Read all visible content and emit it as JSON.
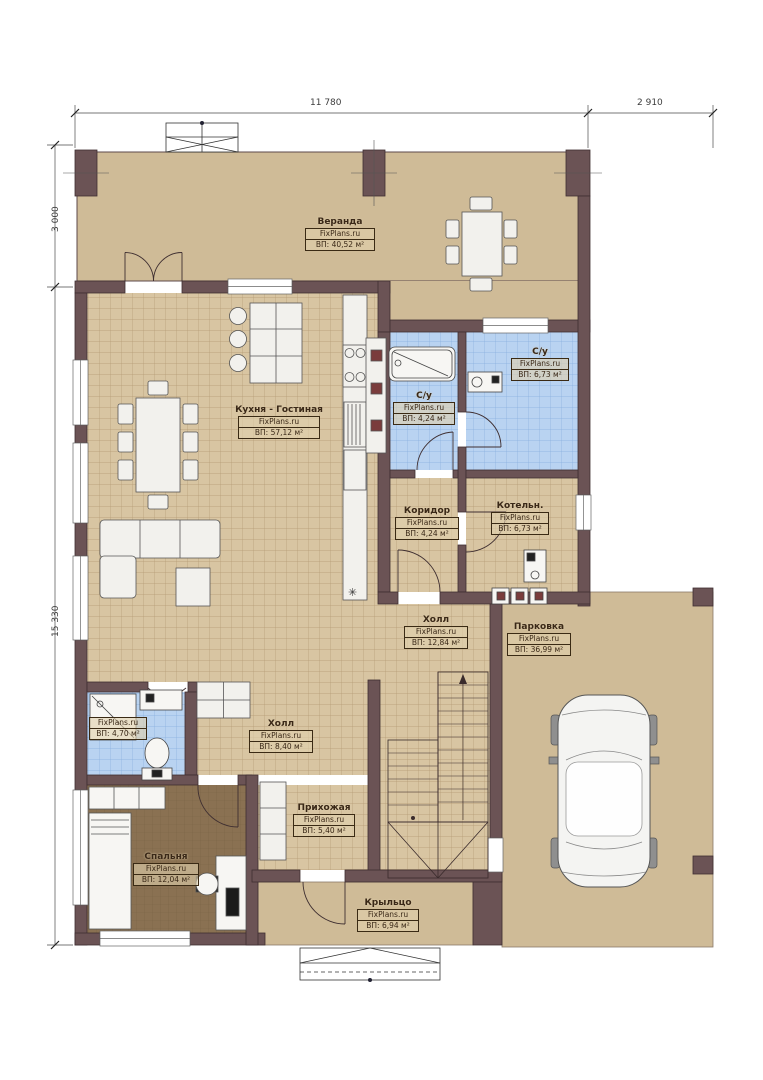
{
  "brand": "FixPlans.ru",
  "dimensions": {
    "top_main": "11 780",
    "top_right": "2 910",
    "left_top": "3 000",
    "left_main": "15 330"
  },
  "rooms": [
    {
      "title": "Веранда",
      "brand": "FixPlans.ru",
      "area": "ВП: 40,52 м²"
    },
    {
      "title": "Кухня - Гостиная",
      "brand": "FixPlans.ru",
      "area": "ВП: 57,12 м²"
    },
    {
      "title": "С/у",
      "brand": "FixPlans.ru",
      "area": "ВП: 4,24 м²"
    },
    {
      "title": "С/у",
      "brand": "FixPlans.ru",
      "area": "ВП: 6,73 м²"
    },
    {
      "title": "Коридор",
      "brand": "FixPlans.ru",
      "area": "ВП: 4,24 м²"
    },
    {
      "title": "Котельн.",
      "brand": "FixPlans.ru",
      "area": "ВП: 6,73 м²"
    },
    {
      "title": "Холл",
      "brand": "FixPlans.ru",
      "area": "ВП: 12,84 м²"
    },
    {
      "title": "Парковка",
      "brand": "FixPlans.ru",
      "area": "ВП: 36,99 м²"
    },
    {
      "title": "",
      "brand": "FixPlans.ru",
      "area": "ВП: 4,70 м²"
    },
    {
      "title": "Холл",
      "brand": "FixPlans.ru",
      "area": "ВП: 8,40 м²"
    },
    {
      "title": "Прихожая",
      "brand": "FixPlans.ru",
      "area": "ВП: 5,40 м²"
    },
    {
      "title": "Спальня",
      "brand": "FixPlans.ru",
      "area": "ВП: 12,04 м²"
    },
    {
      "title": "Крыльцо",
      "brand": "FixPlans.ru",
      "area": "ВП: 6,94 м²"
    }
  ],
  "colors": {
    "wall": "#6b5355",
    "terrace_floor": "#cfbb97",
    "tile_floor": "#d8c5a2",
    "bath_tile": "#b9d3f1",
    "bedroom_floor": "#8a7152"
  }
}
